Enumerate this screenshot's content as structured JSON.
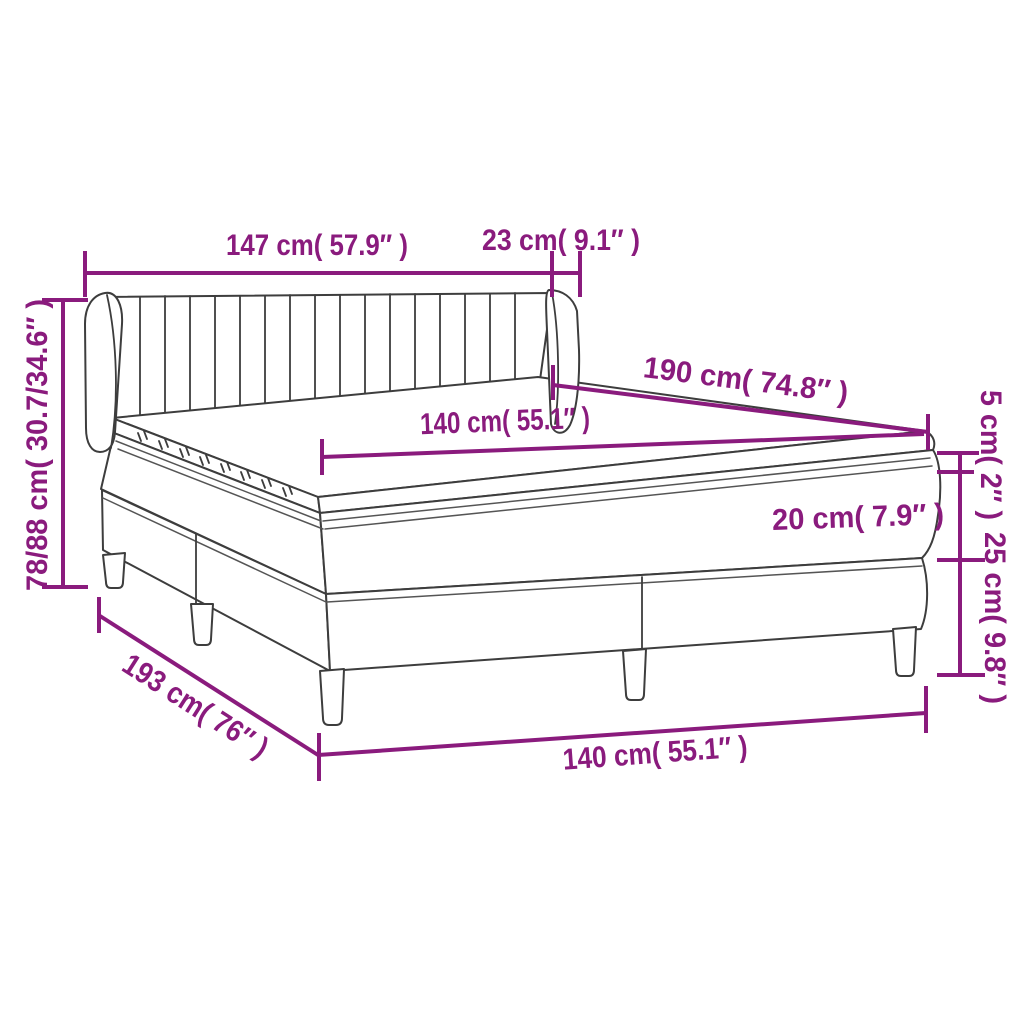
{
  "colors": {
    "dimension": "#8A1B7D",
    "outline": "#3D3D3D",
    "piping": "#555555",
    "background": "#FFFFFF"
  },
  "labels": {
    "headboard_width": "147 cm( 57.9″ )",
    "wing_depth": "23 cm( 9.1″ )",
    "total_height": "78/88 cm( 30.7/34.6″ )",
    "mattress_length": "190 cm( 74.8″ )",
    "mattress_width": "140 cm( 55.1″ )",
    "topper_thickness": "5 cm( 2″ )",
    "mattress_thickness": "20 cm( 7.9″ )",
    "base_height": "25 cm( 9.8″ )",
    "total_length": "193 cm( 76″ )",
    "bed_width": "140 cm( 55.1″ )"
  }
}
